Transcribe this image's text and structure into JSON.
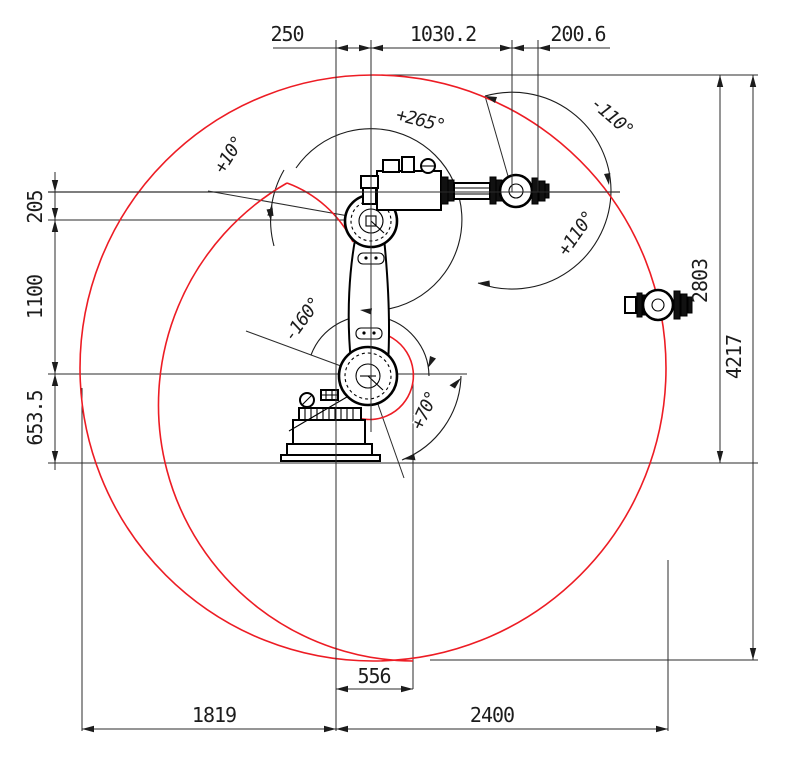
{
  "dims": {
    "top": {
      "a": "250",
      "b": "1030.2",
      "c": "200.6"
    },
    "left": {
      "a": "205",
      "b": "1100",
      "c": "653.5"
    },
    "right": {
      "a": "2803",
      "b": "4217"
    },
    "bottom": {
      "a": "556",
      "b": "1819",
      "c": "2400"
    }
  },
  "angles": {
    "plus10": "+10°",
    "plus265": "+265°",
    "minus110": "-110°",
    "plus110": "+110°",
    "minus160": "-160°",
    "plus70": "+70°"
  },
  "colors": {
    "envelope_red": "#ed1c24",
    "drawing_black": "#000000",
    "line_gray": "#2b2b2b"
  }
}
